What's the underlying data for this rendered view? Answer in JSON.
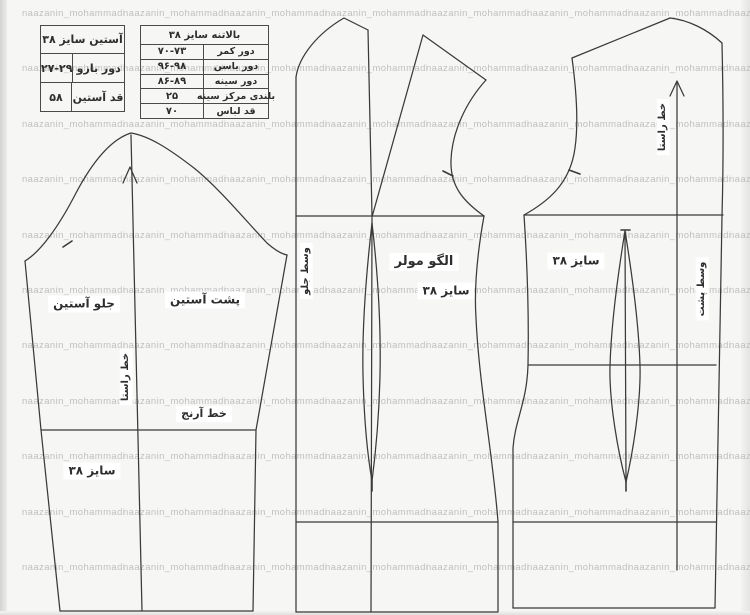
{
  "watermark": {
    "text": "naazanin_mohammadi",
    "color": "#c0c0c0",
    "cols": 8,
    "rows": 12,
    "x0": 22,
    "y0": 8,
    "dx": 101,
    "dy": 55.4
  },
  "colors": {
    "background": "#f6f6f4",
    "line": "#3a3a3a",
    "ink": "#2e2e2e",
    "label_bg": "#ffffff"
  },
  "tables": {
    "sleeve": {
      "title": "آستین سایز ۳۸",
      "rows": [
        {
          "label": "دور بازو",
          "value": "۲۷-۲۹"
        },
        {
          "label": "قد آستین",
          "value": "۵۸"
        }
      ]
    },
    "bodice": {
      "title": "بالاتنه سایز ۳۸",
      "rows": [
        {
          "label": "دور کمر",
          "value": "۷۰-۷۳"
        },
        {
          "label": "دور باسن",
          "value": "۹۶-۹۸"
        },
        {
          "label": "دور سینه",
          "value": "۸۶-۸۹"
        },
        {
          "label": "بلندی مرکز سینه",
          "value": "۲۵"
        },
        {
          "label": "قد لباس",
          "value": "۷۰"
        }
      ]
    }
  },
  "labels": {
    "sleeve_front": "جلو آستین",
    "sleeve_back": "پشت آستین",
    "sleeve_grainline": "خط راستا",
    "elbow_line": "خط آرنج",
    "sleeve_size": "سایز ۳۸",
    "front_pattern_title": "الگو مولر",
    "front_pattern_size": "سایز ۳۸",
    "center_front": "وسط جلو",
    "back_size": "سایز ۳۸",
    "back_grainline": "خط راستا",
    "center_back": "وسط پشت"
  }
}
